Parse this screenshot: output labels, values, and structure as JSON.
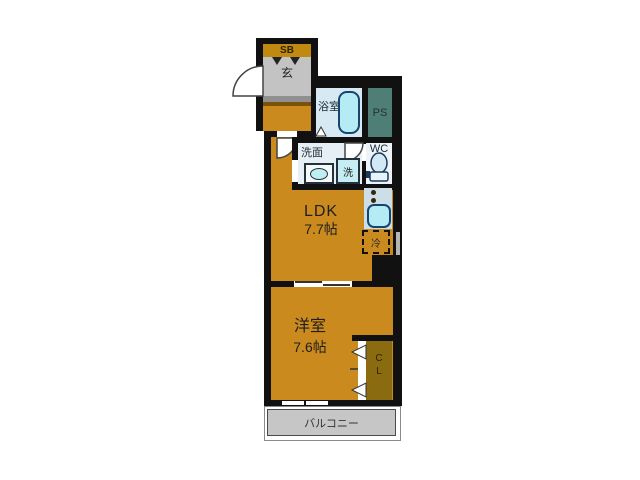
{
  "plan": {
    "shoe_box": {
      "label": "SB"
    },
    "entrance": {
      "label": "玄"
    },
    "bathroom": {
      "label": "浴室"
    },
    "pipe_space": {
      "label": "PS"
    },
    "washroom": {
      "label": "洗面"
    },
    "washing_machine": {
      "label": "洗"
    },
    "toilet": {
      "label": "WC"
    },
    "ldk": {
      "label": "LDK",
      "size": "7.7帖"
    },
    "refrigerator": {
      "label": "冷"
    },
    "western_room": {
      "label": "洋室",
      "size": "7.6帖"
    },
    "closet": {
      "letter_top": "C",
      "letter_bottom": "L"
    },
    "balcony": {
      "label": "バルコニー"
    }
  },
  "colors": {
    "wall": "#111111",
    "floor_orange": "#cb8a1d",
    "closet_brown": "#8b6b10",
    "entrance_gray": "#c3c3c3",
    "balcony_gray": "#c6c6c6",
    "wet_area_blue": "#d7e9f2",
    "fixture_cyan": "#b5ebf5",
    "fixture_border": "#16466e",
    "pipe_space_teal": "#4e7e76",
    "shoe_box_gold": "#c08a10"
  }
}
